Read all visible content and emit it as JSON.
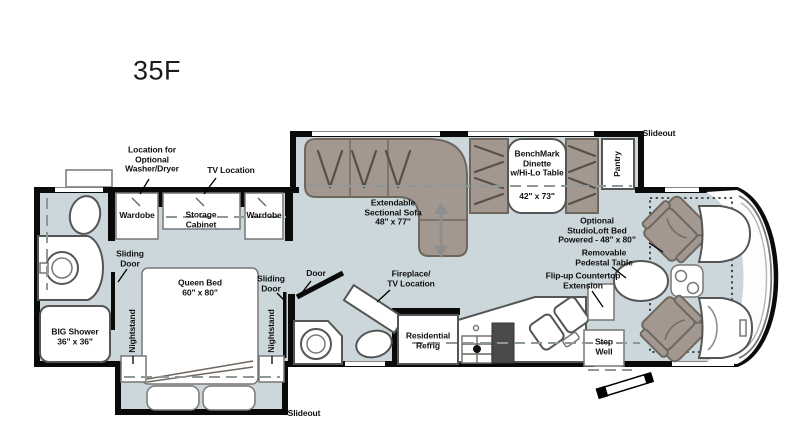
{
  "title": "35F",
  "colors": {
    "floor": "#ccd7db",
    "furniture": "#a39890",
    "wall": "#0a0a0a",
    "outline": "#6f675e"
  },
  "labels": {
    "washer_dryer": "Location for\nOptional\nWasher/Dryer",
    "tv_location": "TV Location",
    "wardrobe_left": "Wardobe",
    "wardrobe_right": "Wardobe",
    "storage_cabinet": "Storage\nCabinet",
    "sliding_door_left": "Sliding\nDoor",
    "sliding_door_right": "Sliding\nDoor",
    "door": "Door",
    "queen_bed": "Queen Bed\n60\" x 80\"",
    "nightstand_left": "Nightstand",
    "nightstand_right": "Nightstand",
    "big_shower": "BIG Shower\n36\" x 36\"",
    "sofa": "Extendable\nSectional Sofa\n48\" x 77\"",
    "dinette": "BenchMark\nDinette\nw/Hi-Lo Table",
    "dinette_size": "42\" x 73\"",
    "pantry": "Pantry",
    "slideout_top": "Slideout",
    "slideout_bottom": "Slideout",
    "fireplace": "Fireplace/\nTV Location",
    "studioloft_bed": "Optional\nStudioLoft Bed\nPowered - 48\" x 80\"",
    "pedestal_table": "Removable\nPedestal Table",
    "flipup_countertop": "Flip-up Countertop\nExtension",
    "residential_refrig": "Residential\nRefrig",
    "step_well": "Step\nWell"
  }
}
